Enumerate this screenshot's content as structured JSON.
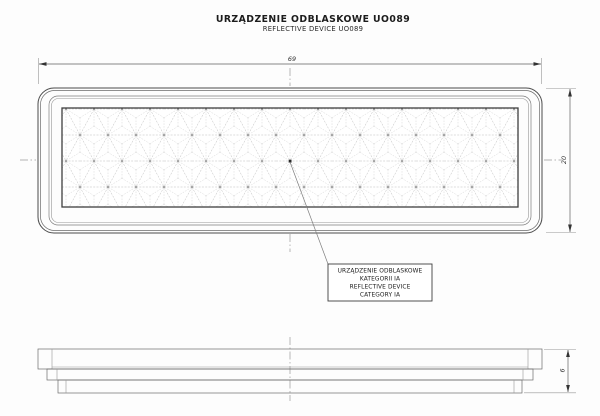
{
  "title": {
    "line1": "URZĄDZENIE ODBLASKOWE UO089",
    "line2": "REFLECTIVE DEVICE UO089"
  },
  "dimensions": {
    "width_label": "69",
    "height_label": "20",
    "thickness_label": "6"
  },
  "label_box": {
    "line1": "URZĄDZENIE ODBLASKOWE",
    "line2": "KATEGORII IA",
    "line3": "REFLECTIVE DEVICE",
    "line4": "CATEGORY IA"
  },
  "colors": {
    "background": "#fdfdfd",
    "outline": "#4a4a4a",
    "hairline": "#979797",
    "pattern_line": "#b3b3b3",
    "text": "#1c1c1c"
  }
}
